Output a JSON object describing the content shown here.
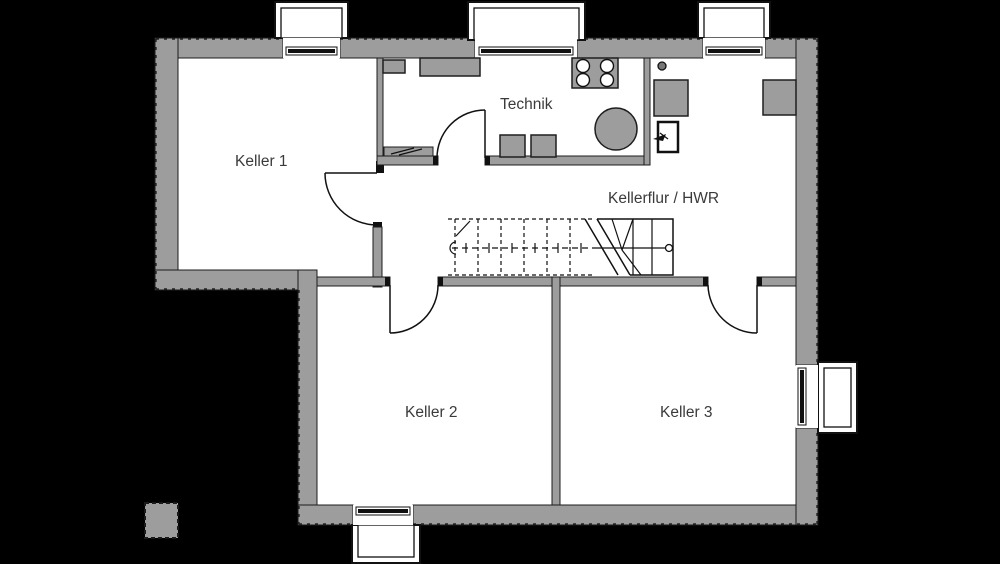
{
  "plan": {
    "type": "basement-floor-plan",
    "rooms": [
      {
        "id": "keller-1",
        "label": "Keller 1"
      },
      {
        "id": "technik",
        "label": "Technik"
      },
      {
        "id": "kellerflur-hwr",
        "label": "Kellerflur / HWR"
      },
      {
        "id": "keller-2",
        "label": "Keller 2"
      },
      {
        "id": "keller-3",
        "label": "Keller 3"
      }
    ],
    "features": {
      "windows": 5,
      "doors": 4,
      "stair": "U-stair with break line, walking line and landing circle",
      "equipment": [
        "manifold-4-ports",
        "boiler-tank",
        "storage-blocks",
        "floor-drain",
        "water-meter-box",
        "cabinet-left",
        "cabinet-right"
      ],
      "pillar": "dashed gray pillar outside south-west corner"
    },
    "colors": {
      "background": "#000000",
      "wall": "#9d9d9d",
      "room_fill": "#ffffff",
      "line": "#111111",
      "text": "#3a3a3a"
    }
  }
}
